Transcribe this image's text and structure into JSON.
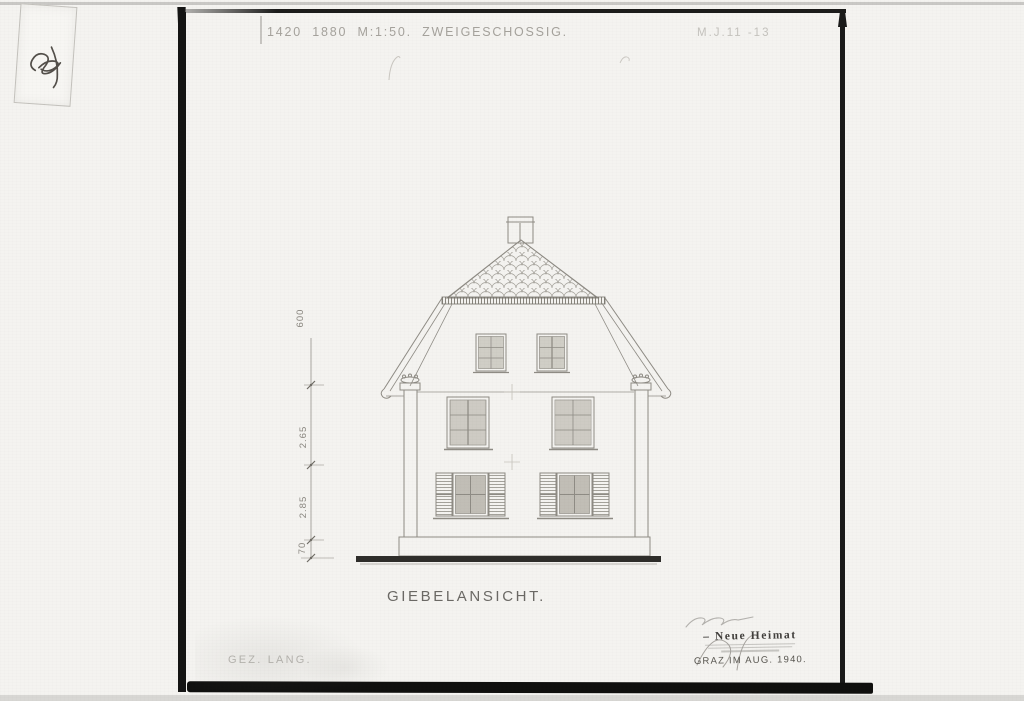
{
  "header": {
    "left": "1420 1880 M:1:50. ZWEIGESCHOSSIG.",
    "right": "M.J.11 -13"
  },
  "drawing": {
    "caption": "GIEBELANSICHT.",
    "dim_labels": [
      "600",
      "2.65",
      "2.85",
      "70"
    ],
    "elements": {
      "chimney": "chimney",
      "roof": "shingled gable roof",
      "attic_windows": 2,
      "upper_windows": 2,
      "ground_windows_with_shutters": 2,
      "corner_pilasters": 2
    }
  },
  "stamp": {
    "name_line": "– Neue Heimat",
    "place_date": "GRAZ IM AUG. 1940."
  },
  "footer": {
    "drawn_by": "GEZ. LANG."
  },
  "tag": {
    "mark": "handwritten numeral"
  },
  "colors": {
    "paper": "#f4f3f0",
    "frame_black": "#141413",
    "ink_faint": "#8e8b84",
    "ground_bar": "#2e2d2a"
  }
}
